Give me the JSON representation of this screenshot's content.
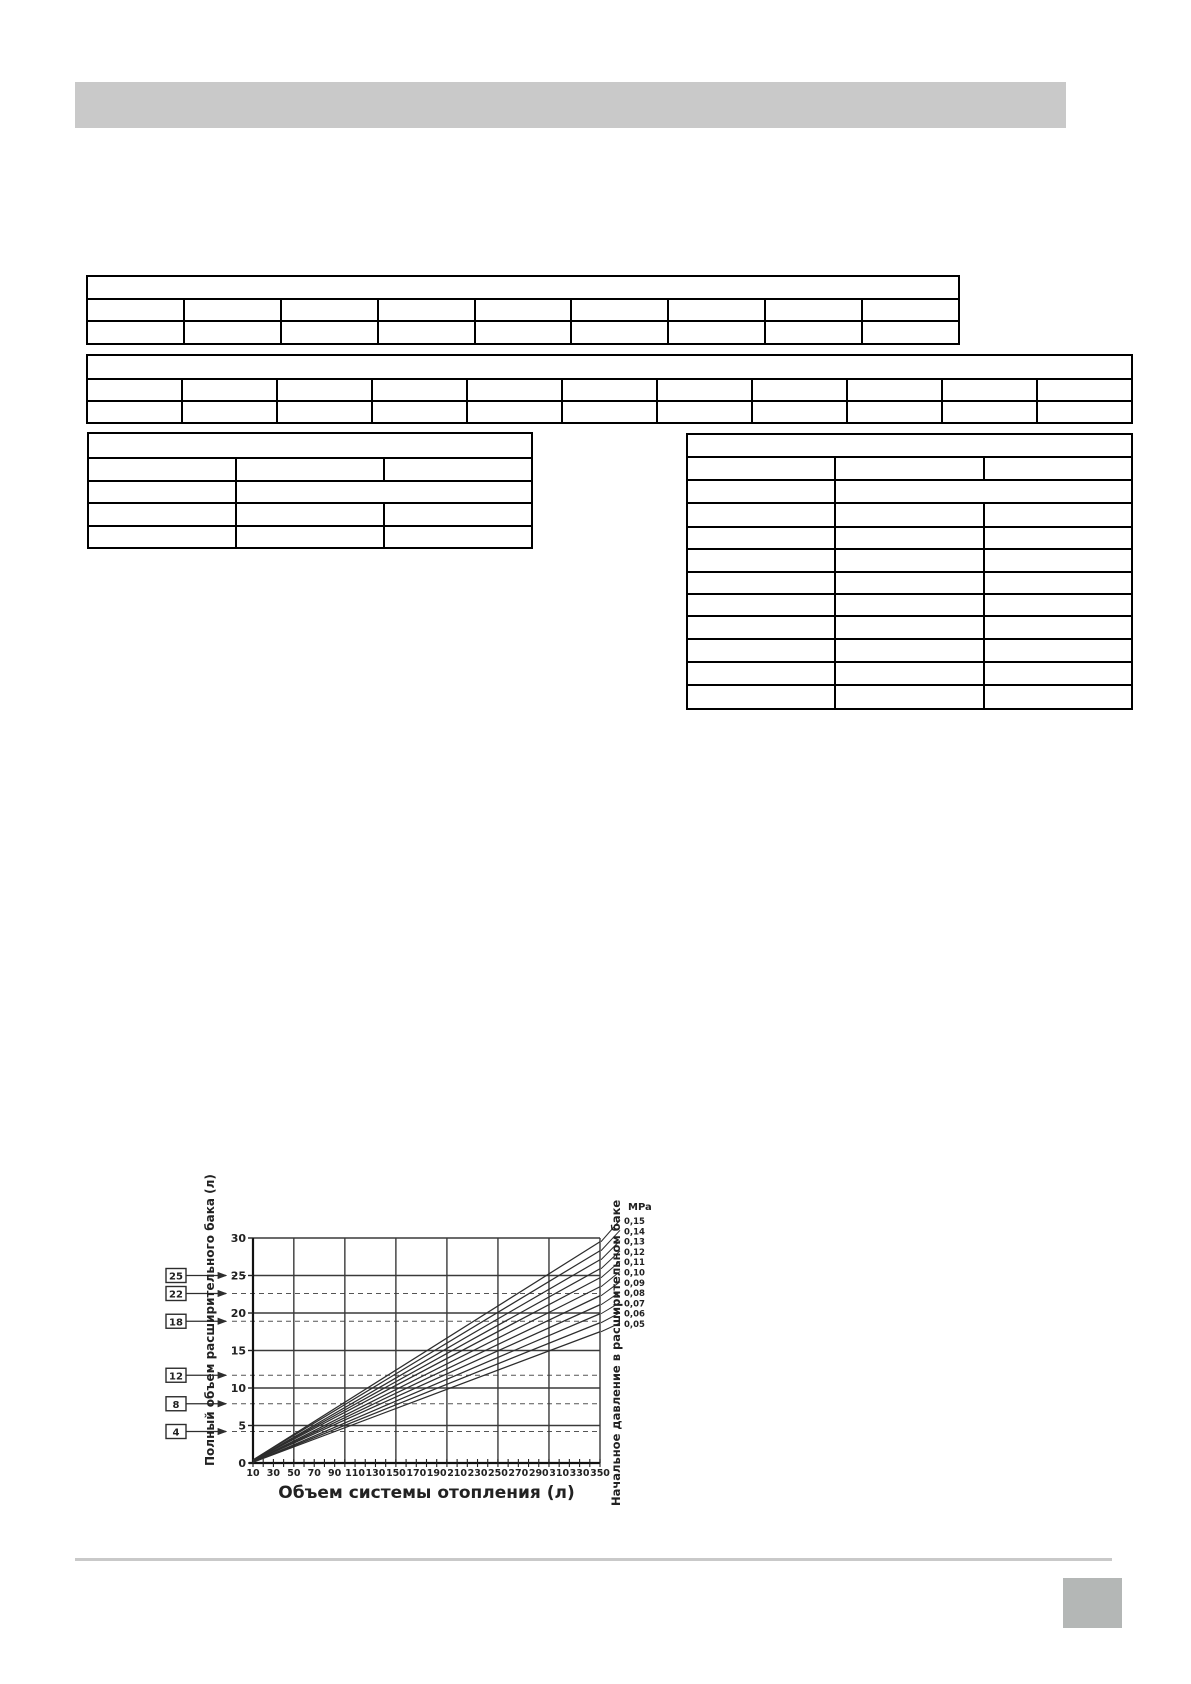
{
  "colors": {
    "header_bar": "#c9c9c9",
    "footer_line": "#c9c9c9",
    "footer_square": "#b4b7b6",
    "table_border": "#000000",
    "chart_ink": "#2d2d2d"
  },
  "tables": {
    "table1": {
      "title_cell": "",
      "data_columns": 8,
      "data_rows": 2,
      "cells": []
    },
    "table2": {
      "title_cell": "",
      "data_columns": 10,
      "data_rows": 2,
      "cells": []
    },
    "table3": {
      "title_cell": "",
      "data_columns": 3,
      "data_rows": 4,
      "merged_row_index": 2,
      "cells": []
    },
    "table4": {
      "title_cell": "",
      "data_columns": 3,
      "data_rows": 11,
      "merged_row_index": 2,
      "cells": []
    }
  },
  "chart_data": {
    "type": "line",
    "title": "",
    "xlabel": "Объем системы отопления (л)",
    "ylabel": "Полный объем расширительного бака (л)",
    "ylabel_right": "Начальное давление в расширительном баке",
    "pressure_unit": "MPa",
    "xlim": [
      10,
      350
    ],
    "ylim": [
      0,
      30
    ],
    "x_tick_labels": [
      10,
      30,
      50,
      70,
      90,
      110,
      130,
      150,
      170,
      190,
      210,
      230,
      250,
      270,
      290,
      310,
      330,
      350
    ],
    "x_minor_step": 10,
    "x_grid_values": [
      50,
      100,
      150,
      200,
      250,
      300,
      350
    ],
    "y_tick_labels": [
      0,
      5,
      10,
      15,
      20,
      25,
      30
    ],
    "grid": true,
    "legend_position": "right",
    "series": [
      {
        "name": "0,15",
        "points": [
          [
            10,
            0.4
          ],
          [
            350,
            29.5
          ]
        ]
      },
      {
        "name": "0,14",
        "points": [
          [
            10,
            0.4
          ],
          [
            350,
            28.3
          ]
        ]
      },
      {
        "name": "0,13",
        "points": [
          [
            10,
            0.3
          ],
          [
            350,
            27.1
          ]
        ]
      },
      {
        "name": "0,12",
        "points": [
          [
            10,
            0.3
          ],
          [
            350,
            25.9
          ]
        ]
      },
      {
        "name": "0,11",
        "points": [
          [
            10,
            0.3
          ],
          [
            350,
            24.7
          ]
        ]
      },
      {
        "name": "0,10",
        "points": [
          [
            10,
            0.2
          ],
          [
            350,
            23.5
          ]
        ]
      },
      {
        "name": "0,09",
        "points": [
          [
            10,
            0.2
          ],
          [
            350,
            22.3
          ]
        ]
      },
      {
        "name": "0,08",
        "points": [
          [
            10,
            0.2
          ],
          [
            350,
            21.1
          ]
        ]
      },
      {
        "name": "0,07",
        "points": [
          [
            10,
            0.1
          ],
          [
            350,
            19.9
          ]
        ]
      },
      {
        "name": "0,06",
        "points": [
          [
            10,
            0.1
          ],
          [
            350,
            18.7
          ]
        ]
      },
      {
        "name": "0,05",
        "points": [
          [
            10,
            0.1
          ],
          [
            350,
            17.5
          ]
        ]
      }
    ],
    "tank_volume_callouts": [
      {
        "label": "25",
        "line_value": 25.0
      },
      {
        "label": "22",
        "line_value": 22.6
      },
      {
        "label": "18",
        "line_value": 18.9
      },
      {
        "label": "12",
        "line_value": 11.7
      },
      {
        "label": "8",
        "line_value": 7.9
      },
      {
        "label": "4",
        "line_value": 4.2
      }
    ]
  }
}
